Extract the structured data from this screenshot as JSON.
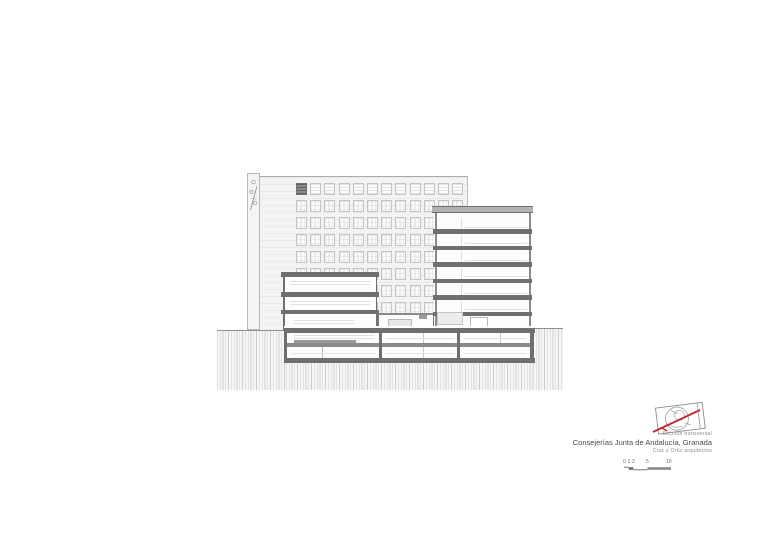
{
  "page": {
    "background": "#ffffff"
  },
  "title_block": {
    "drawing_type": "Sección  transversal",
    "project_title": "Consejerías Junta de Andalucía, Granada",
    "architects": "Cruz y Ortiz arquitectos",
    "logo_name": "cruz-y-ortiz-stamp",
    "accent_color": "#c22b38"
  },
  "scale_bar": {
    "labels": [
      "0",
      "1",
      "2",
      "5",
      "10"
    ],
    "meters": [
      0,
      1,
      2,
      5,
      10
    ]
  },
  "drawing": {
    "type": "architectural-section",
    "elevation": {
      "window_rows": 8,
      "window_cols": 12,
      "row_start_y": 183,
      "row_pitch": 17,
      "row_height": 11.5,
      "col_start_x": 296,
      "col_pitch": 14.2,
      "col_width": 11,
      "top_row_style": "louvre",
      "dark_cell_index": 0
    },
    "section": {
      "tower_floor_slabs": 6,
      "tower_slab_start_y": 23,
      "tower_slab_pitch": 16.5,
      "wing_floor_slabs": 3,
      "basement_levels": 2
    },
    "colors": {
      "facade": "#f3f3f3",
      "slab": "#767676",
      "roof_slab": "#b3b3b3",
      "hatch_line": "#cdcdcd",
      "outline": "#a0a0a0",
      "window_frame": "#c4c4c4",
      "red_accent": "#c22b38"
    }
  }
}
